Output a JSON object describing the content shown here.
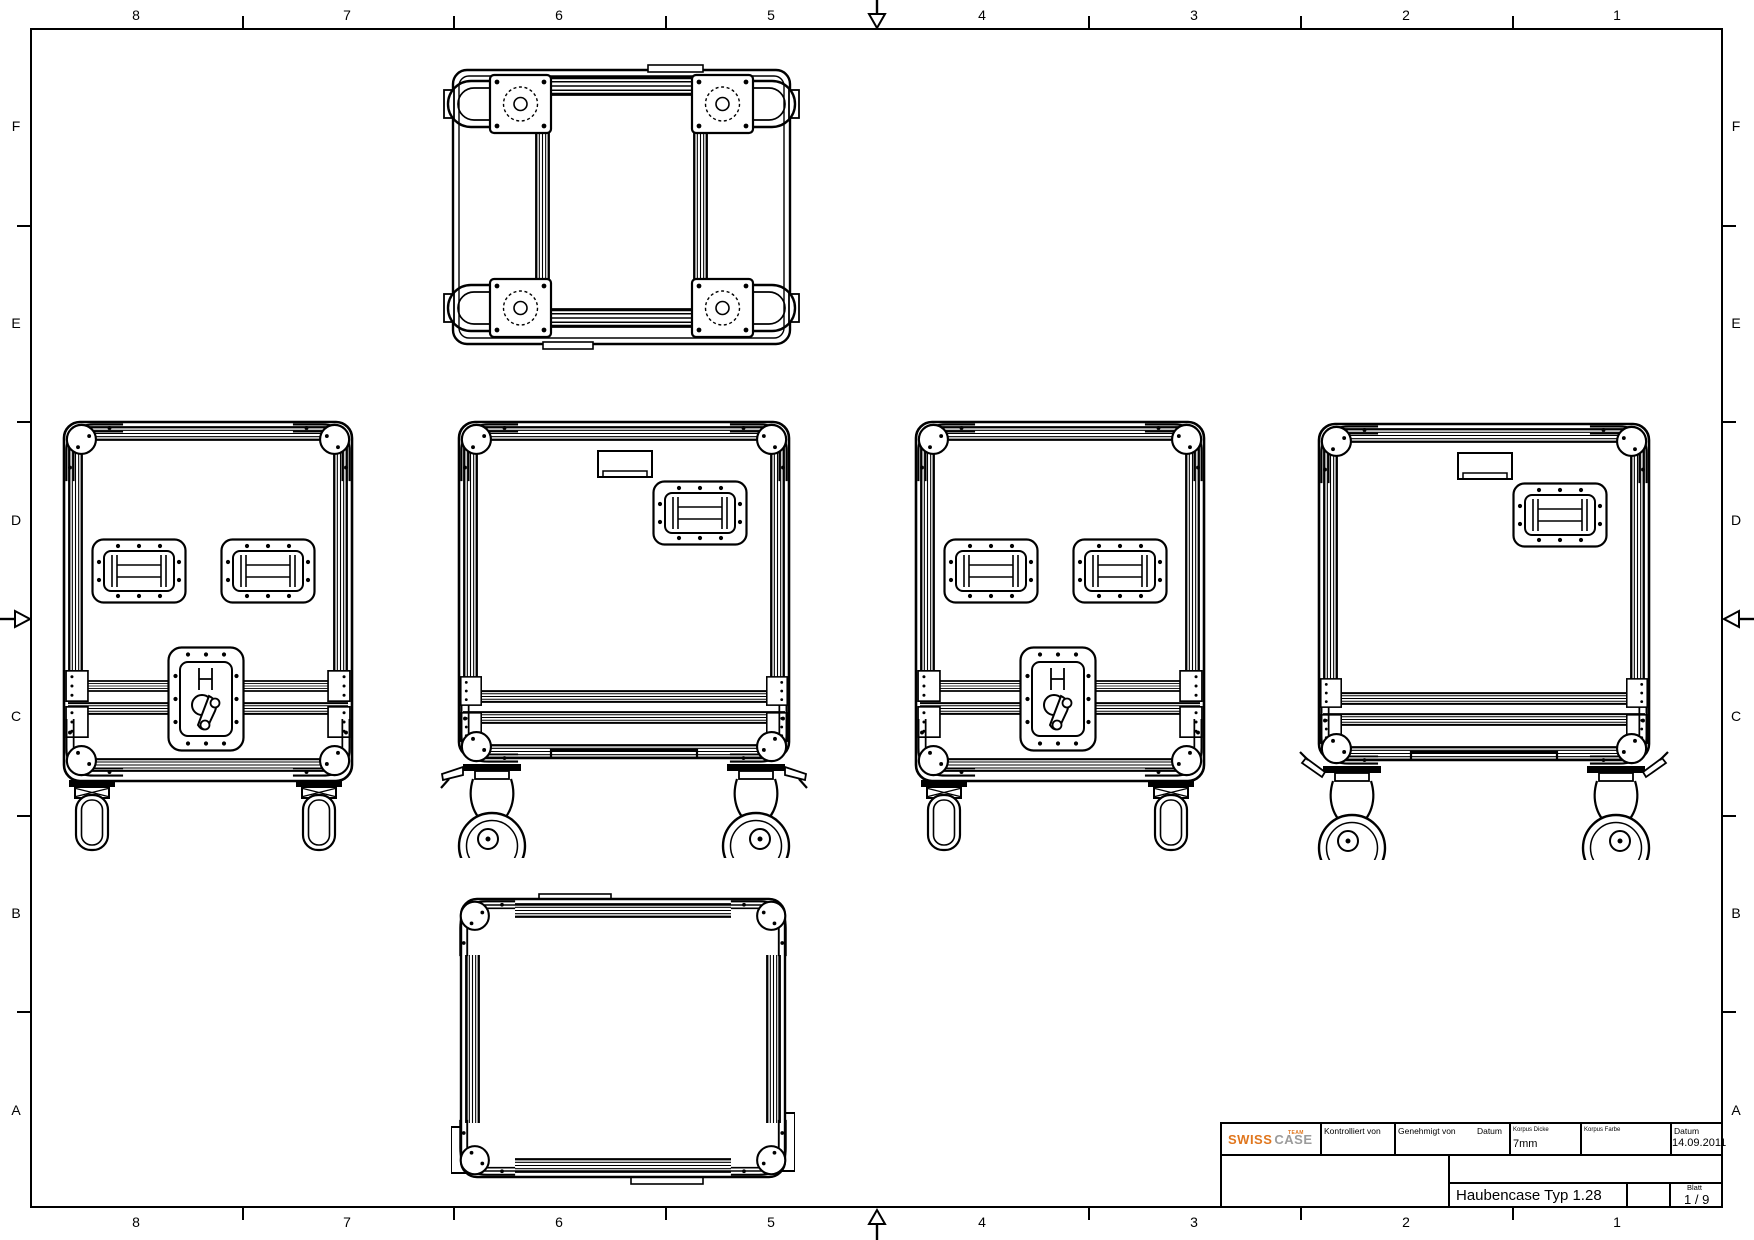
{
  "grid": {
    "cols": [
      "8",
      "7",
      "6",
      "5",
      "4",
      "3",
      "2",
      "1"
    ],
    "rows": [
      "F",
      "E",
      "D",
      "C",
      "B",
      "A"
    ]
  },
  "tb": {
    "logo_swiss": "SWISS",
    "logo_case": "CASE",
    "logo_team": "TEAM",
    "kontrolliert_label": "Kontrolliert von",
    "genehmigt_label": "Genehmigt von",
    "datum_label": "Datum",
    "korpus_dicke_label": "Korpus Dicke",
    "korpus_dicke_value": "7mm",
    "korpus_farbe_label": "Korpus Farbe",
    "datum2_label": "Datum",
    "datum_value": "14.09.2011",
    "drawing_title": "Haubencase Typ 1.28",
    "blatt_label": "Blatt",
    "blatt_value": "1 / 9"
  },
  "colors": {
    "line": "#000000",
    "background": "#ffffff",
    "logo_orange": "#e0761d",
    "logo_gray": "#9b9b9b"
  }
}
